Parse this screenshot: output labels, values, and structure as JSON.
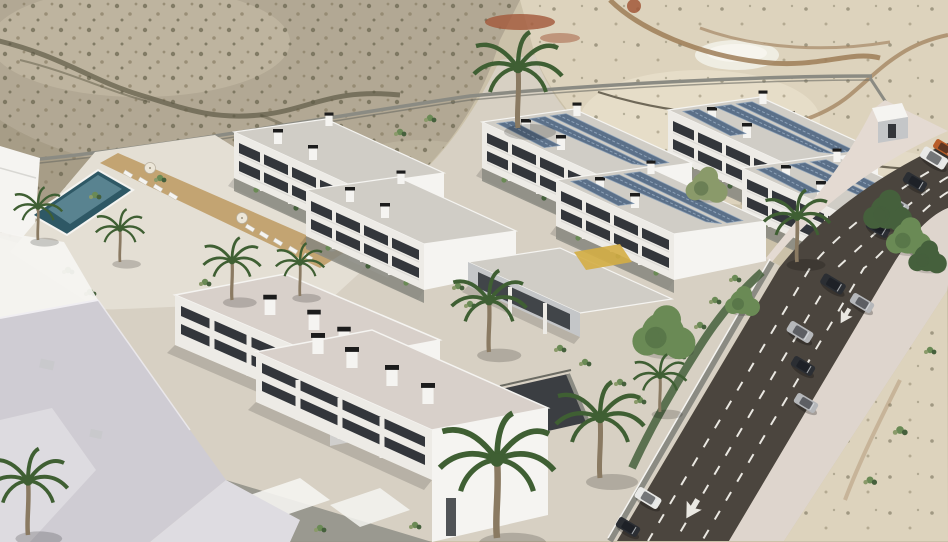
{
  "scene": {
    "type": "aerial-3d-architectural-render",
    "description": "Aerial daytime render of a white modern residential complex with solar-panel roofs, communal swimming pool and palm trees, set on a desert hillside beside a multi-lane road with cars",
    "setting": "desert hillside residential development",
    "time_of_day": "day",
    "counts": {
      "apartment_buildings": 8,
      "buildings_with_solar_panels": 4,
      "community_buildings": 1,
      "swimming_pools": 1,
      "sun_loungers": 9,
      "parasols": 3,
      "palm_trees": 11,
      "cars_driving": 5,
      "cars_queued": 5,
      "cars_parked": 2,
      "road_lanes": 4,
      "road_arrows": 2
    }
  },
  "colors": {
    "sand_base": "#cbc1a9",
    "hillside": "#b2a894",
    "hillside_light": "#c9c0aa",
    "scrub_dark": "#6d6852",
    "scrub_mid": "#8c8168",
    "wash": "#5e5a46",
    "sand_light": "#ddd3bd",
    "sand_pale": "#e8e0cb",
    "dirt_path": "#9d7c57",
    "terrace_line": "#6f6858",
    "pond": "#efede2",
    "red_soil": "#a2583a",
    "road": "#4b453e",
    "road_line": "#eae8e2",
    "sidewalk": "#ded5cd",
    "sidewalk_warm": "#e4dad2",
    "ground_pave": "#d7d0c3",
    "deck": "#e4dfd4",
    "deck_tan": "#c3a472",
    "pool_deep": "#2e5865",
    "pool_light": "#7ea7b5",
    "facade": "#edebe6",
    "facade_shade": "#c4c6c8",
    "gable": "#f5f4f1",
    "window": "#33363b",
    "rail": "#d8d7d3",
    "roof": "#d0cdc6",
    "roof_warm": "#d8d0ca",
    "chimney_cap": "#1c1c1c",
    "solar": "#5b7089",
    "solar_lt": "#8ea2b8",
    "green_dark": "#45603c",
    "green_mid": "#6a8a55",
    "green_dry": "#8a9a6a",
    "palm": "#3f5f33",
    "trunk": "#8a7a62",
    "slab": "#cfccd3",
    "slab_lt": "#dedce1",
    "wall_gray": "#8b8b83",
    "wall_dark": "#6b6b63",
    "play_yellow": "#d4ae45",
    "car_dark": "#2b2e33",
    "car_silver": "#b5b7ba",
    "car_white": "#e9e9e7",
    "truck_orange": "#b85c28"
  }
}
